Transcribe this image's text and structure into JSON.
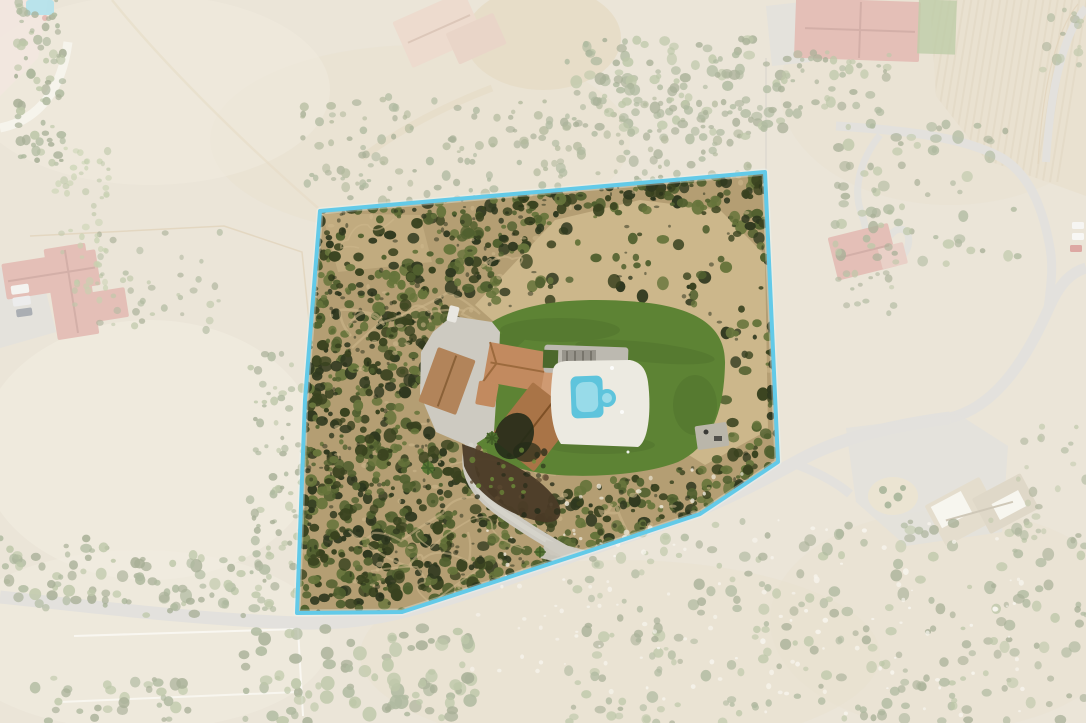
{
  "meta": {
    "description": "Aerial drone photograph of a hillside estate; the subject parcel is outlined in light blue and surrounding properties are faded with a white wash",
    "image_type": "real-estate-aerial-photo"
  },
  "scene": {
    "parcel": {
      "outline_points": "320,211 765,172 778,462 700,514 583,553 402,612 297,613 305,400",
      "border_color": "#63cae8",
      "border_halo": "#e9f8fc",
      "border_width": "4",
      "wash_color": "#ffffff",
      "wash_opacity": "0.5",
      "land_cover": "dense chaparral brush with dirt clearings and trails"
    },
    "subject_property": {
      "main_house": "terracotta tile roof, L-shaped with dark south wing",
      "detached_garage": "tan gable roof",
      "pool": "rectangular pool with round spa and white deck",
      "lawn": "large kidney-shaped lawn",
      "driveway": "concrete motor court with curving drive to road"
    },
    "neighbors": [
      {
        "id": "west-house",
        "roof": "red tile"
      },
      {
        "id": "north-house",
        "roof": "pale terracotta"
      },
      {
        "id": "northeast-house",
        "roof": "red tile"
      },
      {
        "id": "east-house",
        "roof": "red tile with hairpin driveway"
      },
      {
        "id": "southeast-house",
        "roof": "tan with white flat sections"
      }
    ],
    "colors": {
      "terrain_base": "#d6cab0",
      "terrain_pale": "#e4dac2",
      "terrain_warm": "#d2c19e",
      "dirt": "#b49e73",
      "dirt_light": "#cdb88c",
      "brush_dark": "#39421f",
      "brush_mid": "#51602f",
      "brush_light": "#66743b",
      "tree_green": "#5f7440",
      "tree_light": "#7c9053",
      "lawn": "#5d8334",
      "lawn_dark": "#49682a",
      "pool_water": "#5ec4dc",
      "pool_light": "#a2dfeb",
      "pool_deck": "#eceae1",
      "concrete": "#cdcac1",
      "concrete_light": "#dbd8d0",
      "road": "#c6c3ba",
      "roof_terracotta": "#c28a5f",
      "roof_terracotta_dark": "#9c6a3d",
      "roof_brown": "#a97447",
      "roof_red": "#c87f6e",
      "roof_red_dark": "#a75f50",
      "roof_pale": "#dab69c",
      "roof_tan": "#c9bb9a",
      "white_structure": "#efecdf",
      "rock": "#efeadb",
      "garden_dark": "#4a3a26",
      "shadow": "#242b18",
      "fence_white": "#f5f2e8",
      "fence_tan": "#c3a878",
      "furrow": "#c2ad85",
      "patio_gray": "#bcb9b0"
    }
  }
}
